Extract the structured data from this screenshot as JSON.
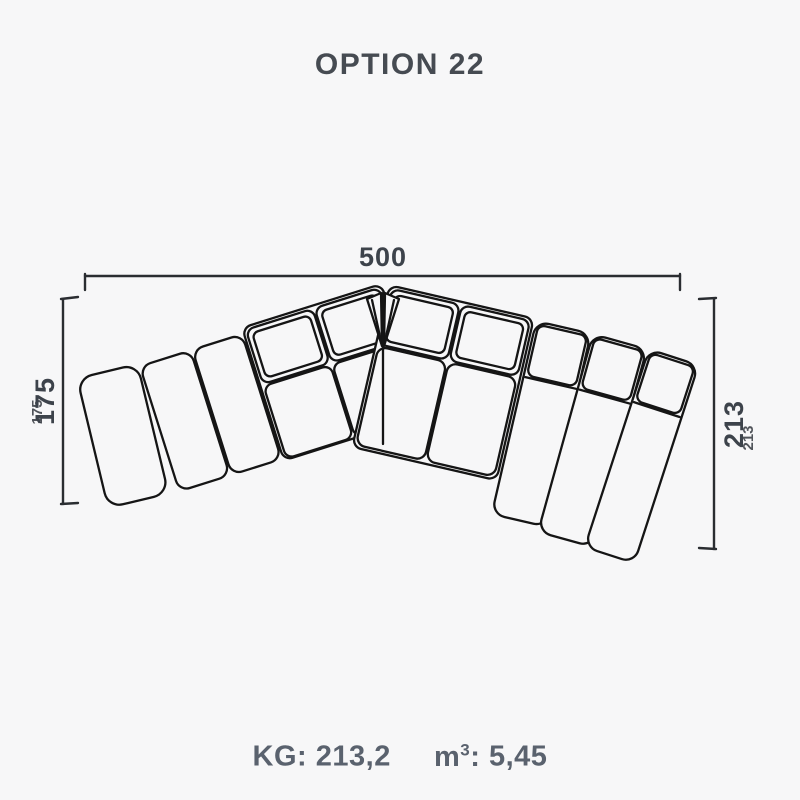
{
  "title": "OPTION 22",
  "dimensions": {
    "width": "500",
    "left_height": "175",
    "right_height": "213"
  },
  "specs": {
    "weight_label": "KG:",
    "weight_value": "213,2",
    "volume_unit_base": "m",
    "volume_unit_sup": "3",
    "volume_separator": ":",
    "volume_value": "5,45"
  },
  "colors": {
    "background": "#f7f7f8",
    "title_text": "#464b52",
    "dimension_text": "#3d434b",
    "specs_text": "#5a626e",
    "drawing_stroke": "#151515"
  }
}
